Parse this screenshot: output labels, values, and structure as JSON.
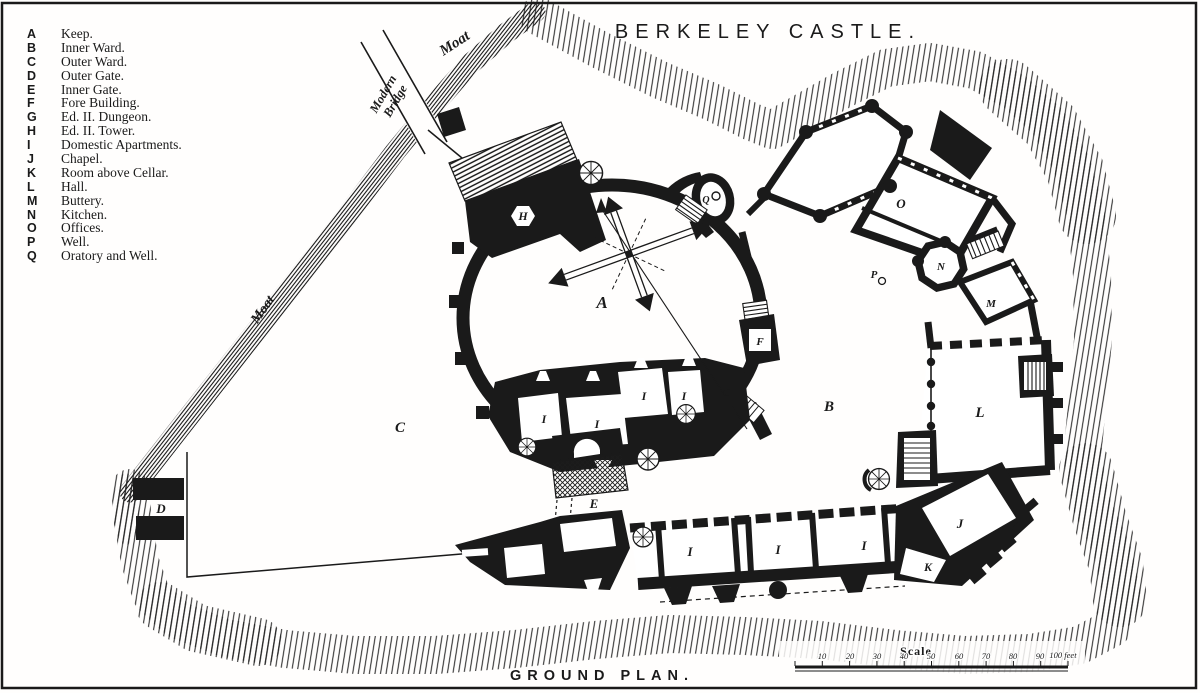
{
  "title": "BERKELEY CASTLE.",
  "caption": "GROUND PLAN.",
  "colors": {
    "ink": "#1a1a1a",
    "paper": "#fffefd"
  },
  "legend": {
    "items": [
      {
        "key": "A",
        "label": "Keep."
      },
      {
        "key": "B",
        "label": "Inner Ward."
      },
      {
        "key": "C",
        "label": "Outer Ward."
      },
      {
        "key": "D",
        "label": "Outer Gate."
      },
      {
        "key": "E",
        "label": "Inner Gate."
      },
      {
        "key": "F",
        "label": "Fore Building."
      },
      {
        "key": "G",
        "label": "Ed. II. Dungeon."
      },
      {
        "key": "H",
        "label": "Ed. II. Tower."
      },
      {
        "key": "I",
        "label": "Domestic Apartments."
      },
      {
        "key": "J",
        "label": "Chapel."
      },
      {
        "key": "K",
        "label": "Room above Cellar."
      },
      {
        "key": "L",
        "label": "Hall."
      },
      {
        "key": "M",
        "label": "Buttery."
      },
      {
        "key": "N",
        "label": "Kitchen."
      },
      {
        "key": "O",
        "label": "Offices."
      },
      {
        "key": "P",
        "label": "Well."
      },
      {
        "key": "Q",
        "label": "Oratory and Well."
      }
    ]
  },
  "map_labels": {
    "moat_top": "Moat",
    "moat_left": "Moat",
    "bridge_line1": "Modern",
    "bridge_line2": "Bridge"
  },
  "scale": {
    "label": "Scale",
    "ticks": [
      "10",
      "20",
      "30",
      "40",
      "50",
      "60",
      "70",
      "80",
      "90"
    ],
    "end_label": "100 feet"
  },
  "plan": {
    "markers": [
      {
        "label": "A"
      },
      {
        "label": "B"
      },
      {
        "label": "C"
      },
      {
        "label": "D"
      },
      {
        "label": "E"
      },
      {
        "label": "F"
      },
      {
        "label": "G"
      },
      {
        "label": "H"
      },
      {
        "label": "I"
      },
      {
        "label": "I"
      },
      {
        "label": "I"
      },
      {
        "label": "I"
      },
      {
        "label": "I"
      },
      {
        "label": "I"
      },
      {
        "label": "I"
      },
      {
        "label": "J"
      },
      {
        "label": "K"
      },
      {
        "label": "L"
      },
      {
        "label": "M"
      },
      {
        "label": "N"
      },
      {
        "label": "O"
      },
      {
        "label": "P"
      },
      {
        "label": "Q"
      }
    ]
  }
}
